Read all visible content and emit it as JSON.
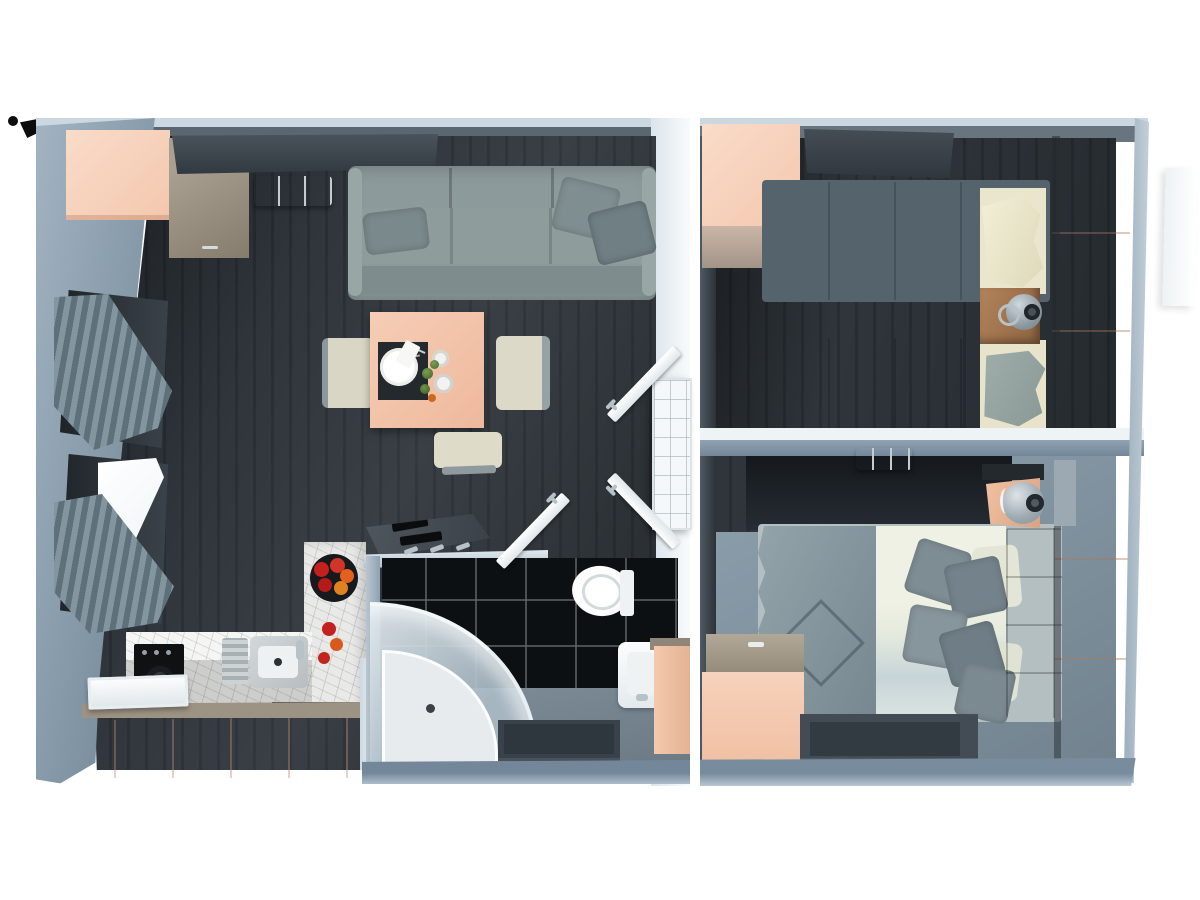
{
  "render": {
    "kind": "3d-floorplan-top-down-render",
    "background": "#ffffff",
    "text_content": "none"
  },
  "palette": {
    "bg": "#ffffff",
    "wall": "#8da2b4",
    "wall-top": "#ccd8e1",
    "wall-face-dark": "#5a6770",
    "wall-lit": "#edf3f7",
    "floor": "#2f353b",
    "plank": "#272d33",
    "floor-gray": "#8294a1",
    "tile": "#0d1013",
    "peach": "#f4c7ae",
    "peach-deep": "#e8b193",
    "peach-light": "#f9dcc9",
    "taupe": "#998f80",
    "wood": "#a27a52",
    "shelf": "#3e464d",
    "sofa": "#8d9a9b",
    "textile": "#5f6e76",
    "cream": "#ebe8cf",
    "duvet": "#e9ecdf",
    "headboard": "#6d7b84",
    "white-furn": "#f5f8fa",
    "chrome": "#b7c1c8",
    "marble": "#e9e9e7",
    "mat": "#434b53",
    "dark": "#121417",
    "apple-red": "#c5201e",
    "apple-orange": "#e2611f",
    "plant-green": "#5d7f3e",
    "lamp-gray": "#a7b1b8"
  },
  "scene": {
    "units": [
      {
        "name": "living-unit",
        "rooms": [
          "living-room",
          "kitchen",
          "bathroom"
        ],
        "objects": [
          "corner-wardrobe",
          "low-cabinet",
          "wall-shelf",
          "air-conditioner",
          "sofa-with-cushions",
          "dining-table",
          "placemat-and-plate",
          "cups",
          "potted-plants",
          "dining-chairs",
          "window-with-curtain",
          "open-window-with-curtain",
          "kitchen-counter",
          "oven",
          "dishwasher",
          "sink-with-faucet",
          "fruit-bowl-with-apples",
          "marble-backsplash",
          "console-with-remotes",
          "radiator",
          "interior-doors",
          "corner-shower",
          "toilet",
          "washbasin",
          "vanity-cabinet",
          "bath-mat",
          "towel-hooks"
        ]
      },
      {
        "name": "bedroom-unit",
        "rooms": [
          "twin-bedroom",
          "double-bedroom"
        ],
        "objects": [
          "corner-wardrobe",
          "wall-shelf",
          "single-bed-1",
          "single-bed-2",
          "nightstand-with-lamp",
          "tall-wardrobe",
          "air-conditioner",
          "double-bed",
          "quilted-throw",
          "pillow-cluster",
          "tufted-headboard",
          "nightstand-with-sphere-lamp",
          "tall-wardrobe-2",
          "dresser",
          "rug"
        ]
      }
    ],
    "exterior": [
      "compass-marker",
      "wall-panel-outside"
    ]
  }
}
